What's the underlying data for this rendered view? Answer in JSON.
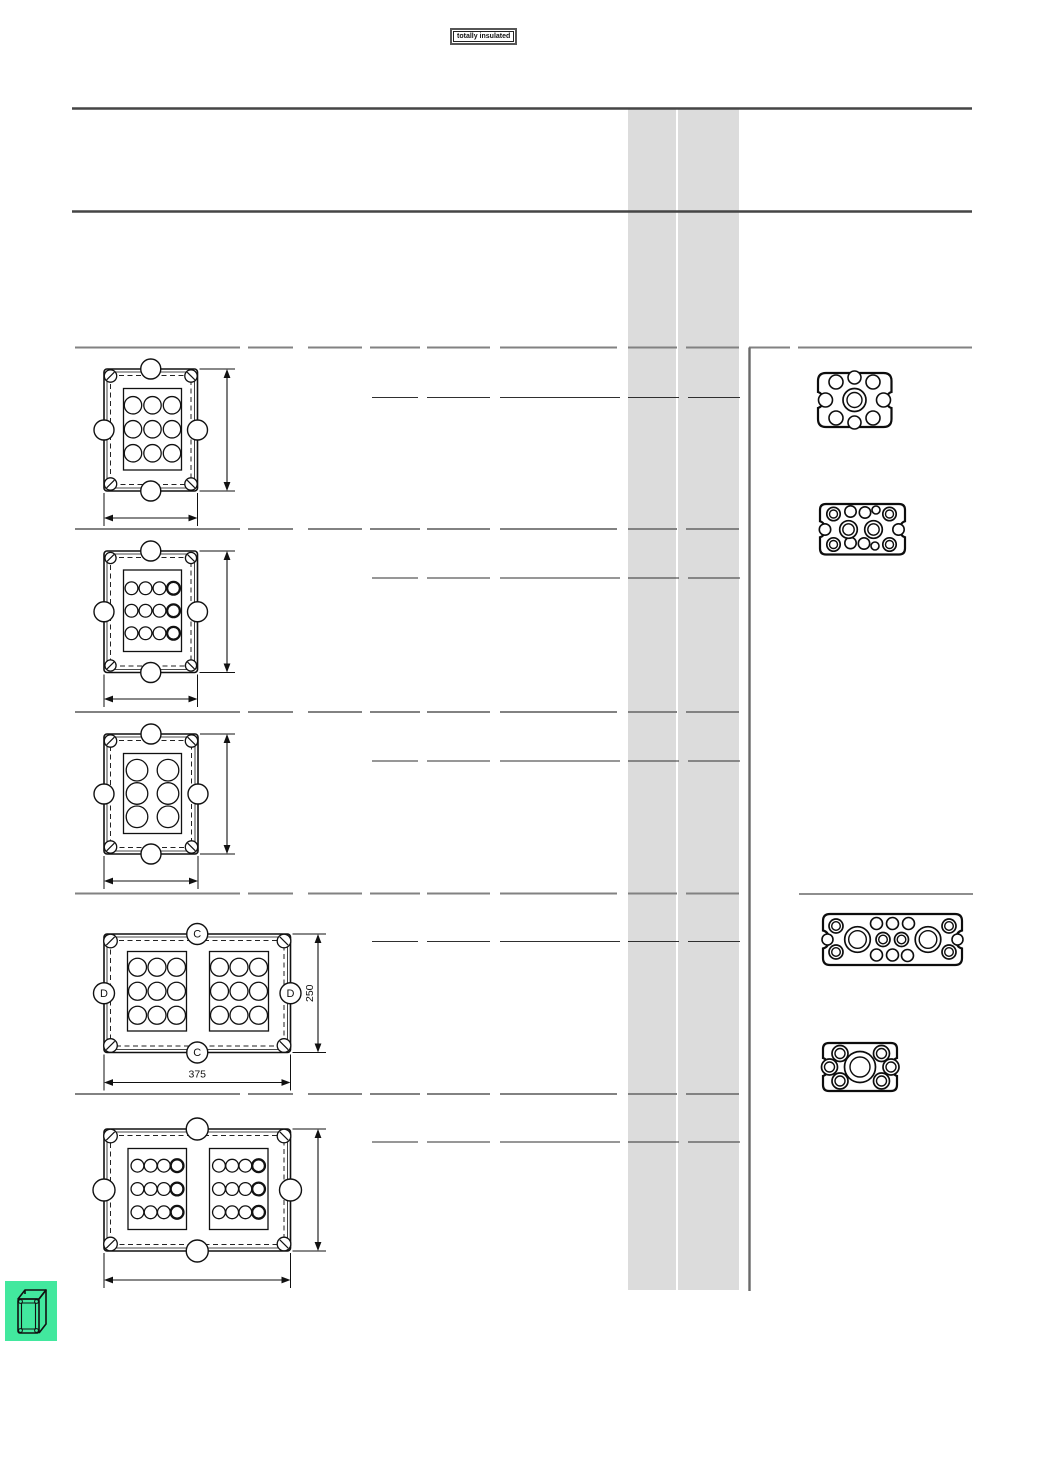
{
  "page": {
    "width": 1040,
    "height": 1473
  },
  "badge": {
    "label": "totally insulated"
  },
  "colors": {
    "accent_green": "#42e89e",
    "band_gray": "#dcdcdc",
    "rule_dark": "#454545",
    "rule_mid": "#828282",
    "rule_thin": "#2f2f2f",
    "ink": "#111111"
  },
  "header": {
    "rule_ys": [
      108.5,
      211.5
    ],
    "x1": 72,
    "x2": 972
  },
  "band": {
    "x1": 628,
    "x2": 739,
    "divider_x": 677,
    "y1": 109,
    "y2": 1290
  },
  "table": {
    "col_segments": [
      [
        75,
        240
      ],
      [
        248,
        293
      ],
      [
        308,
        362
      ],
      [
        370,
        420
      ],
      [
        427,
        490
      ],
      [
        500,
        617
      ],
      [
        628,
        677
      ],
      [
        686,
        739
      ]
    ],
    "main_row_ys": [
      347.5,
      529,
      712,
      893.5,
      1094
    ],
    "sub_row_ys": [
      397.5,
      578,
      761,
      941.5,
      1142
    ],
    "sub_segments": [
      [
        372,
        418
      ],
      [
        427,
        490
      ],
      [
        500,
        620
      ],
      [
        628,
        679
      ],
      [
        688,
        740
      ]
    ],
    "right_top_segments": [
      [
        749,
        790
      ],
      [
        798,
        972
      ]
    ],
    "right_rule": {
      "x": 749.5,
      "y1": 347.5,
      "y2": 1291
    },
    "right_mid_rule": {
      "y": 894,
      "x1": 799,
      "x2": 973
    }
  },
  "enclosures": [
    {
      "name": "enclosure-drawing-1",
      "box": {
        "x": 104,
        "y": 369,
        "w": 93.5,
        "h": 122
      },
      "bump_r": 10,
      "screw_r": 6.2,
      "panels": [
        {
          "x": 123.5,
          "y": 388.5,
          "w": 58,
          "h": 81.5,
          "cols": 3,
          "rows": 3,
          "sx": 19.5,
          "sy": 24,
          "r": 8.7,
          "bold_last": false
        }
      ],
      "dim_v": {
        "x": 227,
        "label": ""
      },
      "dim_h": {
        "y": 518,
        "label": ""
      }
    },
    {
      "name": "enclosure-drawing-2",
      "box": {
        "x": 104,
        "y": 551,
        "w": 93.5,
        "h": 121.5
      },
      "bump_r": 10,
      "screw_r": 5.6,
      "panels": [
        {
          "x": 123.5,
          "y": 570,
          "w": 58,
          "h": 81.5,
          "cols": 4,
          "rows": 3,
          "sx": 14,
          "sy": 22.5,
          "r": 6.4,
          "bold_last": true
        }
      ],
      "dim_v": {
        "x": 227,
        "label": ""
      },
      "dim_h": {
        "y": 699,
        "label": ""
      }
    },
    {
      "name": "enclosure-drawing-3",
      "box": {
        "x": 104,
        "y": 734,
        "w": 94,
        "h": 120
      },
      "bump_r": 10,
      "screw_r": 6.2,
      "panels": [
        {
          "x": 123.5,
          "y": 753.5,
          "w": 58,
          "h": 80,
          "cols": 2,
          "rows": 3,
          "sx": 31,
          "sy": 23.3,
          "r": 10.8,
          "bold_last": false
        }
      ],
      "dim_v": {
        "x": 227,
        "label": ""
      },
      "dim_h": {
        "y": 881,
        "label": ""
      }
    },
    {
      "name": "enclosure-drawing-4",
      "box": {
        "x": 104,
        "y": 934,
        "w": 186.5,
        "h": 118.5
      },
      "bump_r": 10.5,
      "screw_r": 6.8,
      "side_labels": {
        "top": "C",
        "bottom": "C",
        "left": "D",
        "right": "D"
      },
      "panels": [
        {
          "x": 127.5,
          "y": 951.5,
          "w": 59,
          "h": 79.5,
          "cols": 3,
          "rows": 3,
          "sx": 19.5,
          "sy": 24,
          "r": 9,
          "bold_last": false
        },
        {
          "x": 209.5,
          "y": 951.5,
          "w": 59,
          "h": 79.5,
          "cols": 3,
          "rows": 3,
          "sx": 19.5,
          "sy": 24,
          "r": 9,
          "bold_last": false
        }
      ],
      "dim_v": {
        "x": 318,
        "label": "250"
      },
      "dim_h": {
        "y": 1082.5,
        "label": "375"
      }
    },
    {
      "name": "enclosure-drawing-5",
      "box": {
        "x": 104,
        "y": 1129,
        "w": 186.5,
        "h": 122
      },
      "bump_r": 11,
      "screw_r": 6.8,
      "panels": [
        {
          "x": 128,
          "y": 1148.5,
          "w": 58.5,
          "h": 81,
          "cols": 4,
          "rows": 3,
          "sx": 13.2,
          "sy": 23.3,
          "r": 6.4,
          "bold_last": true
        },
        {
          "x": 209.5,
          "y": 1148.5,
          "w": 58.5,
          "h": 81,
          "cols": 4,
          "rows": 3,
          "sx": 13.2,
          "sy": 23.3,
          "r": 6.4,
          "bold_last": true
        }
      ],
      "dim_v": {
        "x": 318,
        "label": ""
      },
      "dim_h": {
        "y": 1280,
        "label": ""
      }
    }
  ],
  "gaskets": [
    {
      "name": "gasket-drawing-1",
      "outline": {
        "x": 818,
        "y": 373,
        "w": 73.5,
        "h": 54,
        "rc": 8,
        "nd": 5,
        "nh": 8
      },
      "rings": [
        [
          854.5,
          400,
          11.5,
          7.5
        ]
      ],
      "circles": [
        [
          836,
          382,
          7
        ],
        [
          854.5,
          377.5,
          6.5
        ],
        [
          873,
          382,
          7
        ],
        [
          825.5,
          400,
          7
        ],
        [
          883.5,
          400,
          7
        ],
        [
          836,
          418,
          7
        ],
        [
          854.5,
          422.5,
          6.5
        ],
        [
          873,
          418,
          7
        ]
      ]
    },
    {
      "name": "gasket-drawing-2",
      "outline": {
        "x": 820,
        "y": 504,
        "w": 85,
        "h": 50.5,
        "rc": 6,
        "nd": 5,
        "nh": 8
      },
      "rings": [
        [
          833.5,
          514,
          6.7,
          4
        ],
        [
          889.5,
          514,
          6.7,
          4
        ],
        [
          833.5,
          544.5,
          6.7,
          4
        ],
        [
          889.5,
          544.5,
          6.7,
          4
        ],
        [
          848.5,
          529.5,
          8.8,
          5.7
        ],
        [
          873.5,
          529.5,
          8.8,
          5.7
        ]
      ],
      "circles": [
        [
          850.5,
          511.5,
          5.7
        ],
        [
          865,
          512.5,
          5.7
        ],
        [
          876,
          510,
          4
        ],
        [
          825,
          529.5,
          5.7
        ],
        [
          898.5,
          529.5,
          5.7
        ],
        [
          850.5,
          543,
          5.7
        ],
        [
          864,
          543.5,
          5.7
        ],
        [
          875,
          546,
          4
        ]
      ]
    },
    {
      "name": "gasket-drawing-3",
      "outline": {
        "x": 823,
        "y": 914,
        "w": 139,
        "h": 51,
        "rc": 7,
        "nd": 6,
        "nh": 9
      },
      "rings": [
        [
          836,
          926,
          7,
          4.3
        ],
        [
          836,
          952,
          7,
          4.3
        ],
        [
          857.5,
          939.5,
          12.8,
          8.8
        ],
        [
          883,
          939.5,
          7,
          4.3
        ],
        [
          901.5,
          939.5,
          7,
          4.3
        ],
        [
          928,
          939.5,
          12.8,
          8.8
        ],
        [
          949,
          926,
          7,
          4.3
        ],
        [
          949,
          952,
          7,
          4.3
        ]
      ],
      "circles": [
        [
          827.5,
          939.5,
          5.5
        ],
        [
          876.5,
          923.5,
          6
        ],
        [
          892.5,
          923.5,
          6
        ],
        [
          908.5,
          923.5,
          6
        ],
        [
          876.5,
          955,
          6
        ],
        [
          892.5,
          955,
          6
        ],
        [
          907.5,
          955.5,
          6
        ],
        [
          957.5,
          939.5,
          5.5
        ]
      ]
    },
    {
      "name": "gasket-drawing-4",
      "outline": {
        "x": 823,
        "y": 1043,
        "w": 74,
        "h": 48,
        "rc": 6,
        "nd": 5,
        "nh": 9
      },
      "rings": [
        [
          860,
          1067,
          15.5,
          10
        ],
        [
          840,
          1053.5,
          8,
          5
        ],
        [
          881.5,
          1053.5,
          8,
          5
        ],
        [
          840,
          1081,
          8,
          5
        ],
        [
          881.5,
          1081,
          8,
          5
        ],
        [
          829.5,
          1067,
          8,
          5
        ],
        [
          891,
          1067,
          8,
          5
        ]
      ],
      "circles": []
    }
  ],
  "corner_icon": {
    "x": 5,
    "y": 1281,
    "w": 52,
    "h": 60
  }
}
